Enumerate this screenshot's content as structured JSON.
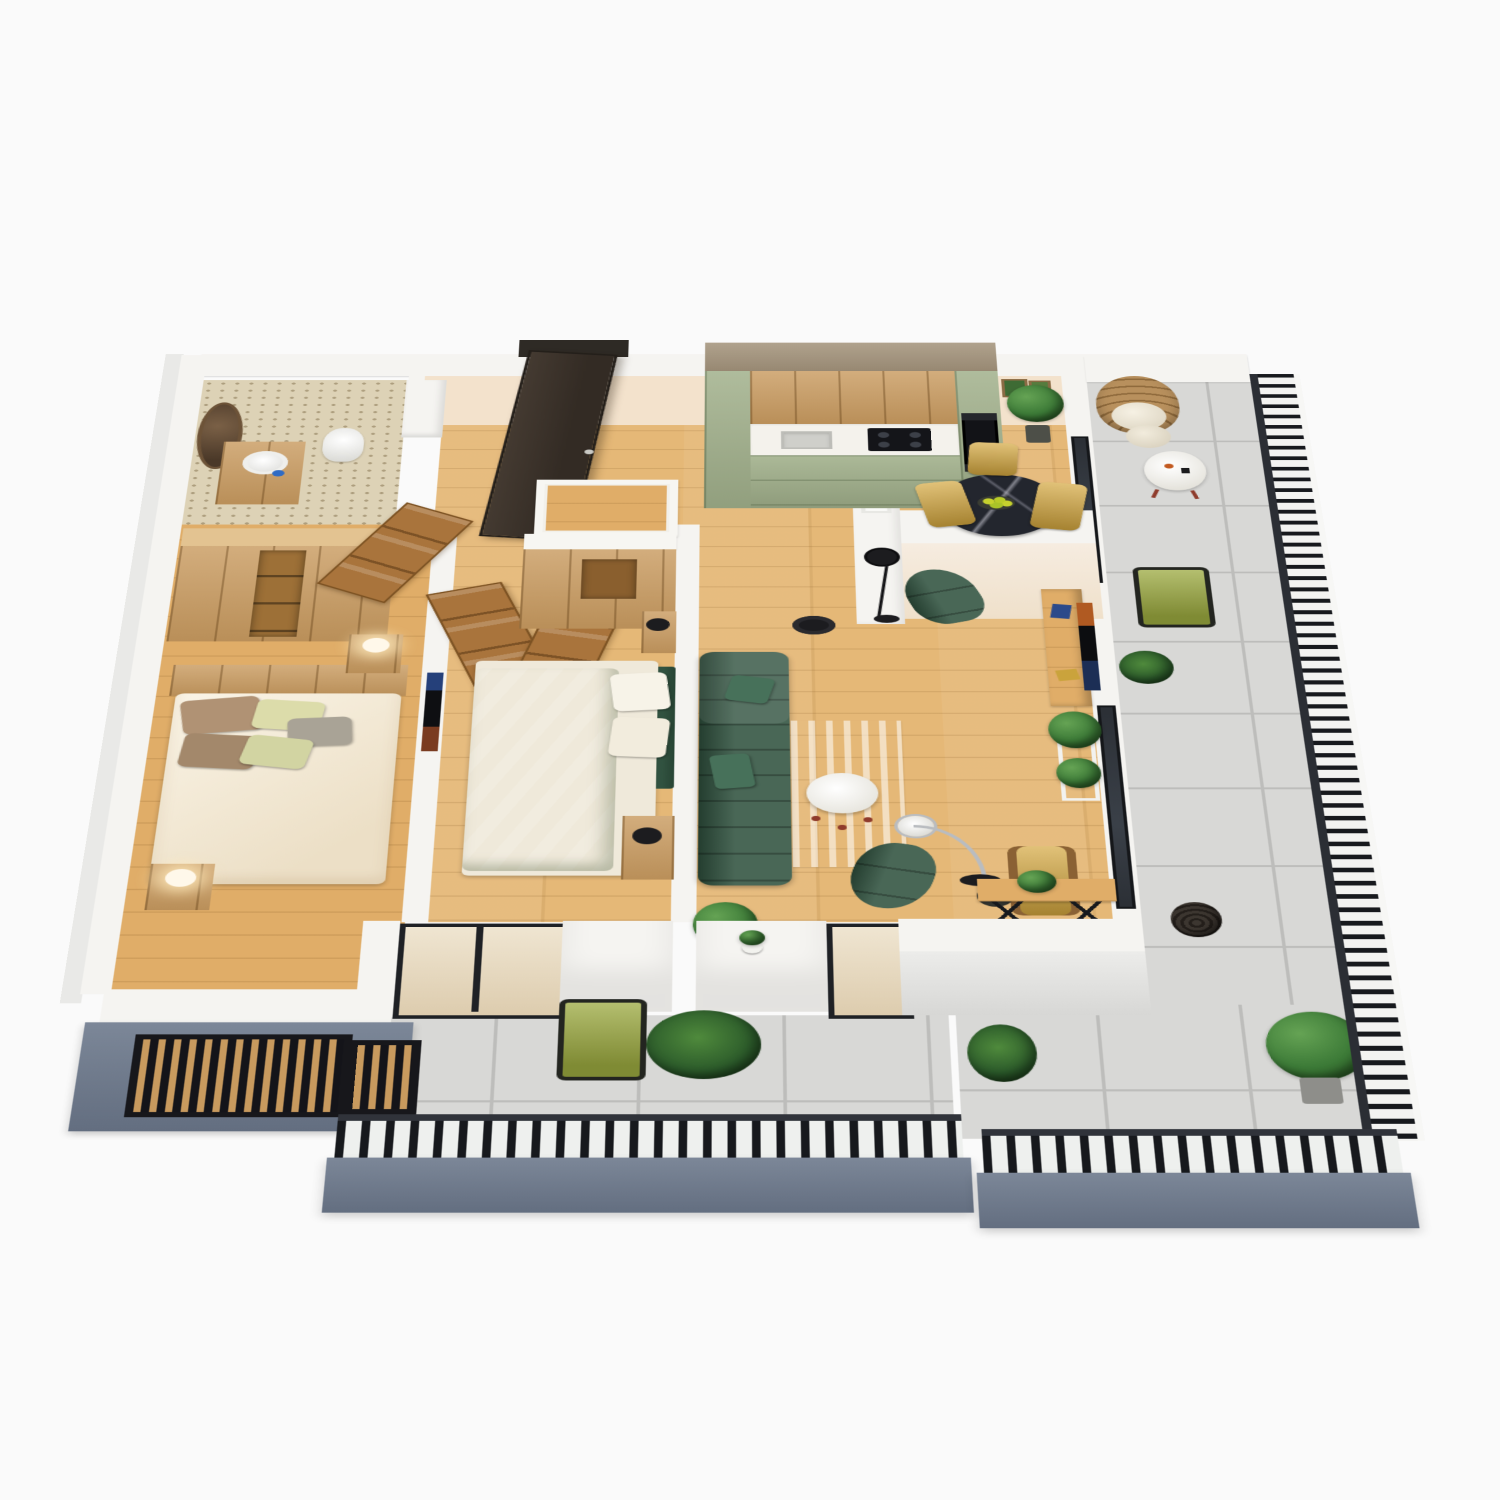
{
  "scene": {
    "kind": "3d-isometric-floor-plan-render",
    "subject": "two-bedroom apartment with wraparound balcony",
    "background": "#fafafa",
    "rooms": [
      {
        "name": "bathroom",
        "furniture": [
          "round-mirror",
          "wood-vanity",
          "vessel-sink",
          "toilet",
          "chevron-shower-floor"
        ]
      },
      {
        "name": "bedroom-1",
        "furniture": [
          "double-bed-cream",
          "oak-headboard",
          "nightstand-lamp-left",
          "nightstand-lamp-right",
          "wardrobe-run",
          "louvered-window"
        ]
      },
      {
        "name": "bedroom-2",
        "furniture": [
          "double-bed-sage",
          "green-headboard",
          "wardrobe",
          "nightstand-north",
          "nightstand-south",
          "wall-tv",
          "floor-plant"
        ]
      },
      {
        "name": "entry-hall",
        "furniture": [
          "entry-door-open",
          "hall-console"
        ]
      },
      {
        "name": "kitchen",
        "furniture": [
          "tall-cabinet-left",
          "upper-cabinets-oak",
          "white-countertop",
          "sink",
          "gas-cooktop",
          "base-cabinets-green",
          "tall-cabinet-ovens",
          "wall-art-frames",
          "corner-plant"
        ]
      },
      {
        "name": "dining",
        "furniture": [
          "round-marble-table",
          "fruit-bowl",
          "mustard-chair-north",
          "mustard-chair-west",
          "mustard-chair-east",
          "half-wall",
          "pass-through-pillar",
          "black-floor-lamp"
        ]
      },
      {
        "name": "living-room",
        "furniture": [
          "green-sofa",
          "striped-rug",
          "round-coffee-table",
          "green-armchair-north",
          "green-armchair-south",
          "arc-lamp",
          "sofa-side-lamp",
          "tv-console",
          "wall-tv",
          "plant-cart",
          "yellow-armchair",
          "dark-side-table",
          "console-table-x-legs",
          "corner-plant"
        ]
      },
      {
        "name": "balcony-right",
        "furniture": [
          "rattan-peacock-chair",
          "white-round-table",
          "olive-rope-chair",
          "fern-basket",
          "wicker-seat",
          "potted-shrub",
          "fiddle-leaf-plant"
        ]
      },
      {
        "name": "balcony-bottom",
        "furniture": [
          "olive-rope-chair",
          "fern-pot",
          "small-white-pot"
        ]
      }
    ]
  },
  "palette": {
    "wallTop": "#f5f4f1",
    "wallFace": "#f3e2cc",
    "wallExt": "#e9e9e7",
    "wood": "#e5b877",
    "woodWarm": "#e0ad68",
    "tile": "#d8d8d6",
    "tileLine": "#bdbdbb",
    "fascia": "#7c8798",
    "fasciaDark": "#636e80",
    "railing": "#17191d",
    "kitchenGreen": "#a2b18c",
    "counter": "#f4f2ec",
    "oak": "#c99b60",
    "oakLight": "#e3c391",
    "sofaGreen": "#30523f",
    "sage": "#b7c5a1",
    "cream": "#f2ead8",
    "mustard": "#d4a73e",
    "olive": "#9ba93f",
    "marble": "#23262e",
    "rattan": "#b8905d",
    "plant": "#3c7a37",
    "plantDark": "#2b5a2a",
    "doorDark": "#3a322b",
    "doorOak": "#a9743c",
    "redLeg": "#8f3b2b"
  }
}
